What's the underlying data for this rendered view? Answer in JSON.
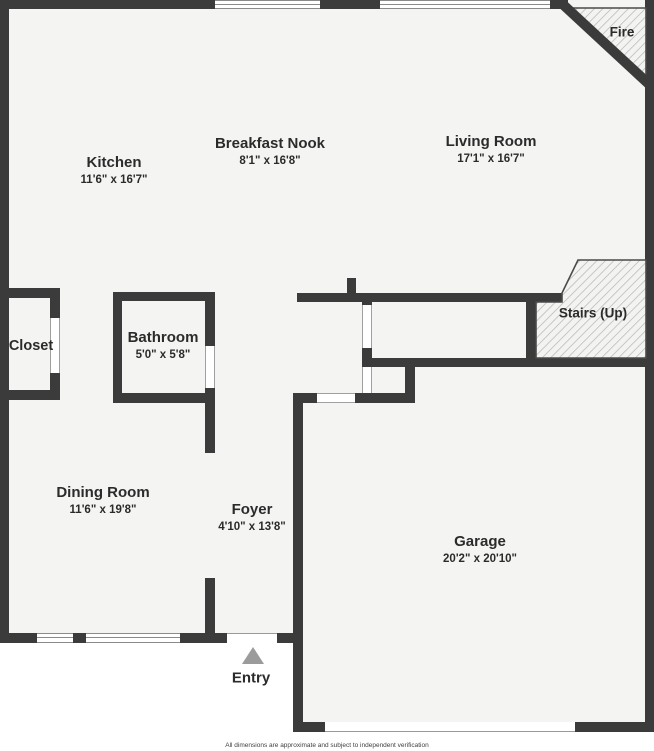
{
  "plan": {
    "rooms": [
      {
        "name": "Kitchen",
        "dims": "11'6\" x 16'7\""
      },
      {
        "name": "Breakfast Nook",
        "dims": "8'1\" x 16'8\""
      },
      {
        "name": "Living Room",
        "dims": "17'1\" x 16'7\""
      },
      {
        "name": "Bathroom",
        "dims": "5'0\" x 5'8\""
      },
      {
        "name": "Dining Room",
        "dims": "11'6\" x 19'8\""
      },
      {
        "name": "Foyer",
        "dims": "4'10\" x 13'8\""
      },
      {
        "name": "Garage",
        "dims": "20'2\" x 20'10\""
      }
    ],
    "labels": {
      "closet": "Closet",
      "stairs": "Stairs (Up)",
      "fire": "Fire",
      "entry": "Entry"
    },
    "footer": "All dimensions are approximate and subject to independent verification",
    "colors": {
      "wall": "#3b3b3b",
      "floor": "#f4f4f3",
      "text": "#2b2b2b",
      "hatch_line": "#b3b3b3",
      "outline": "#4a4a4a",
      "entry_arrow": "#9b9b9b"
    }
  }
}
